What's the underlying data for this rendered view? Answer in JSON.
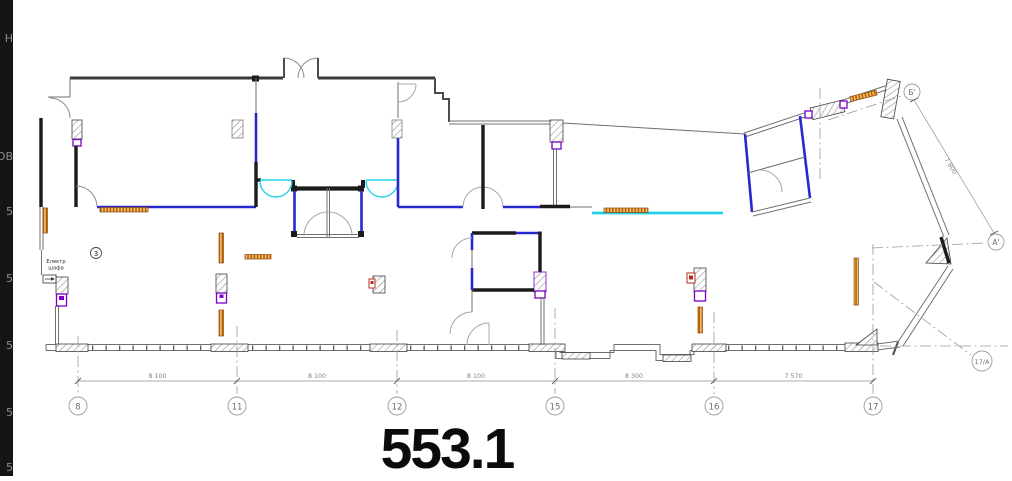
{
  "window": {
    "width": 1012,
    "height": 476,
    "background": "#ffffff"
  },
  "left_panel": {
    "background": "#151515",
    "text_color": "#8f8f8f",
    "fragments": [
      {
        "text": "Н"
      },
      {
        "text": "ОВ"
      },
      {
        "text": "5"
      },
      {
        "text": "5"
      },
      {
        "text": "5"
      },
      {
        "text": "5"
      },
      {
        "text": "5"
      }
    ]
  },
  "plan": {
    "area_value": "553.1",
    "room_tag": "3",
    "cabinet_label": {
      "line1": "Електр",
      "line2": "шафа"
    },
    "grid_markers": [
      "8",
      "11",
      "12",
      "15",
      "16",
      "17"
    ],
    "span_dimensions": [
      "8 100",
      "8 100",
      "8 100",
      "8 300",
      "7 570"
    ],
    "axis_markers": {
      "top_right": "Б'",
      "right": "А'",
      "corner": "17/А"
    },
    "edge_dimension": "7 800",
    "colors": {
      "panel_bg": "#151515",
      "panel_fg": "#8f8f8f",
      "wall": "#1b1b1b",
      "partition_blue": "#2828cf",
      "door_cyan": "#1fd2e8",
      "radiator_orange": "#b35f00",
      "socket_purple": "#7a00c8",
      "alarm_red": "#b2301c",
      "grid_gray": "#9b9b9b"
    }
  }
}
